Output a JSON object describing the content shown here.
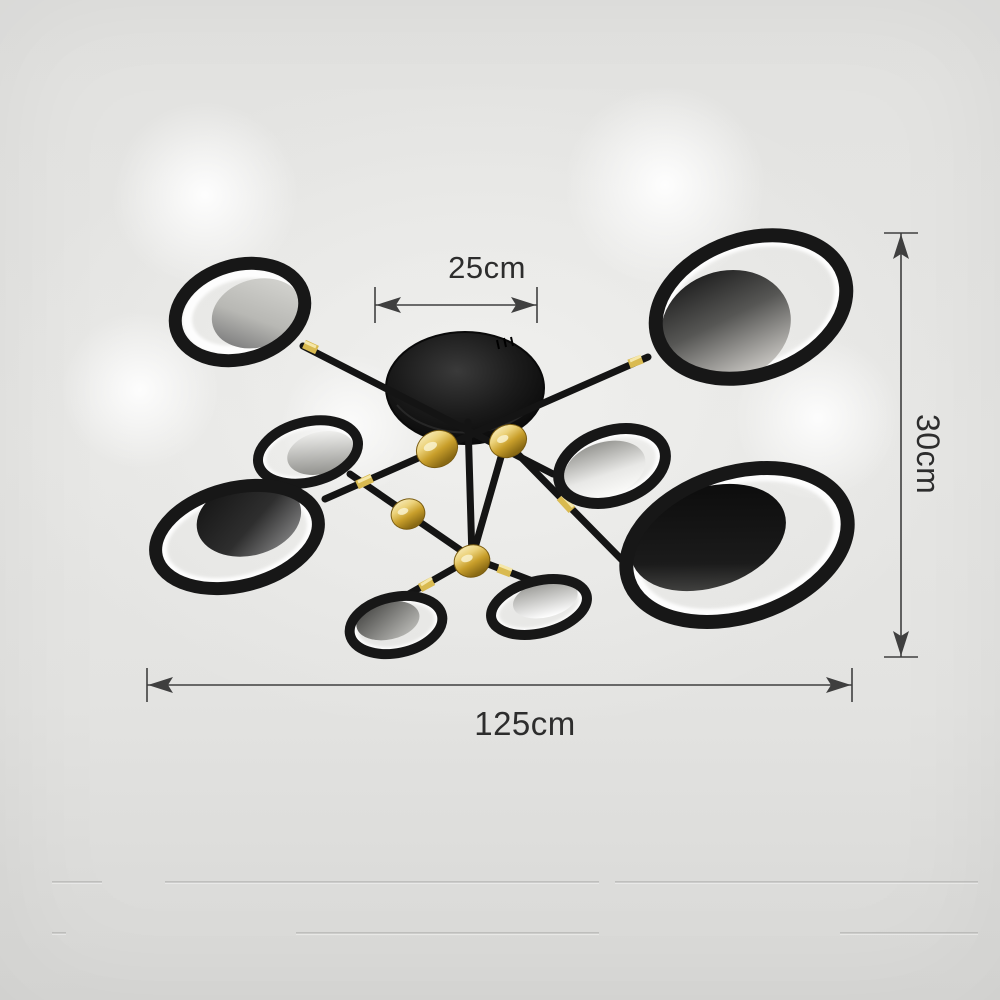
{
  "image": {
    "kind": "product-dimension-photo",
    "subject": "8-ring black and gold LED ceiling chandelier mounted on a light ceiling",
    "ring_count": 8
  },
  "annotations": {
    "canopy_width_label": "25cm",
    "fixture_height_label": "30cm",
    "fixture_width_label": "125cm"
  },
  "colors": {
    "background": "#e4e4e2",
    "fixture_black": "#161616",
    "connector_gold": "#d2ae3f",
    "led_glow": "#ffffff",
    "dimension_lines": "#3f3f3f",
    "dimension_text": "#2d2d2d"
  }
}
